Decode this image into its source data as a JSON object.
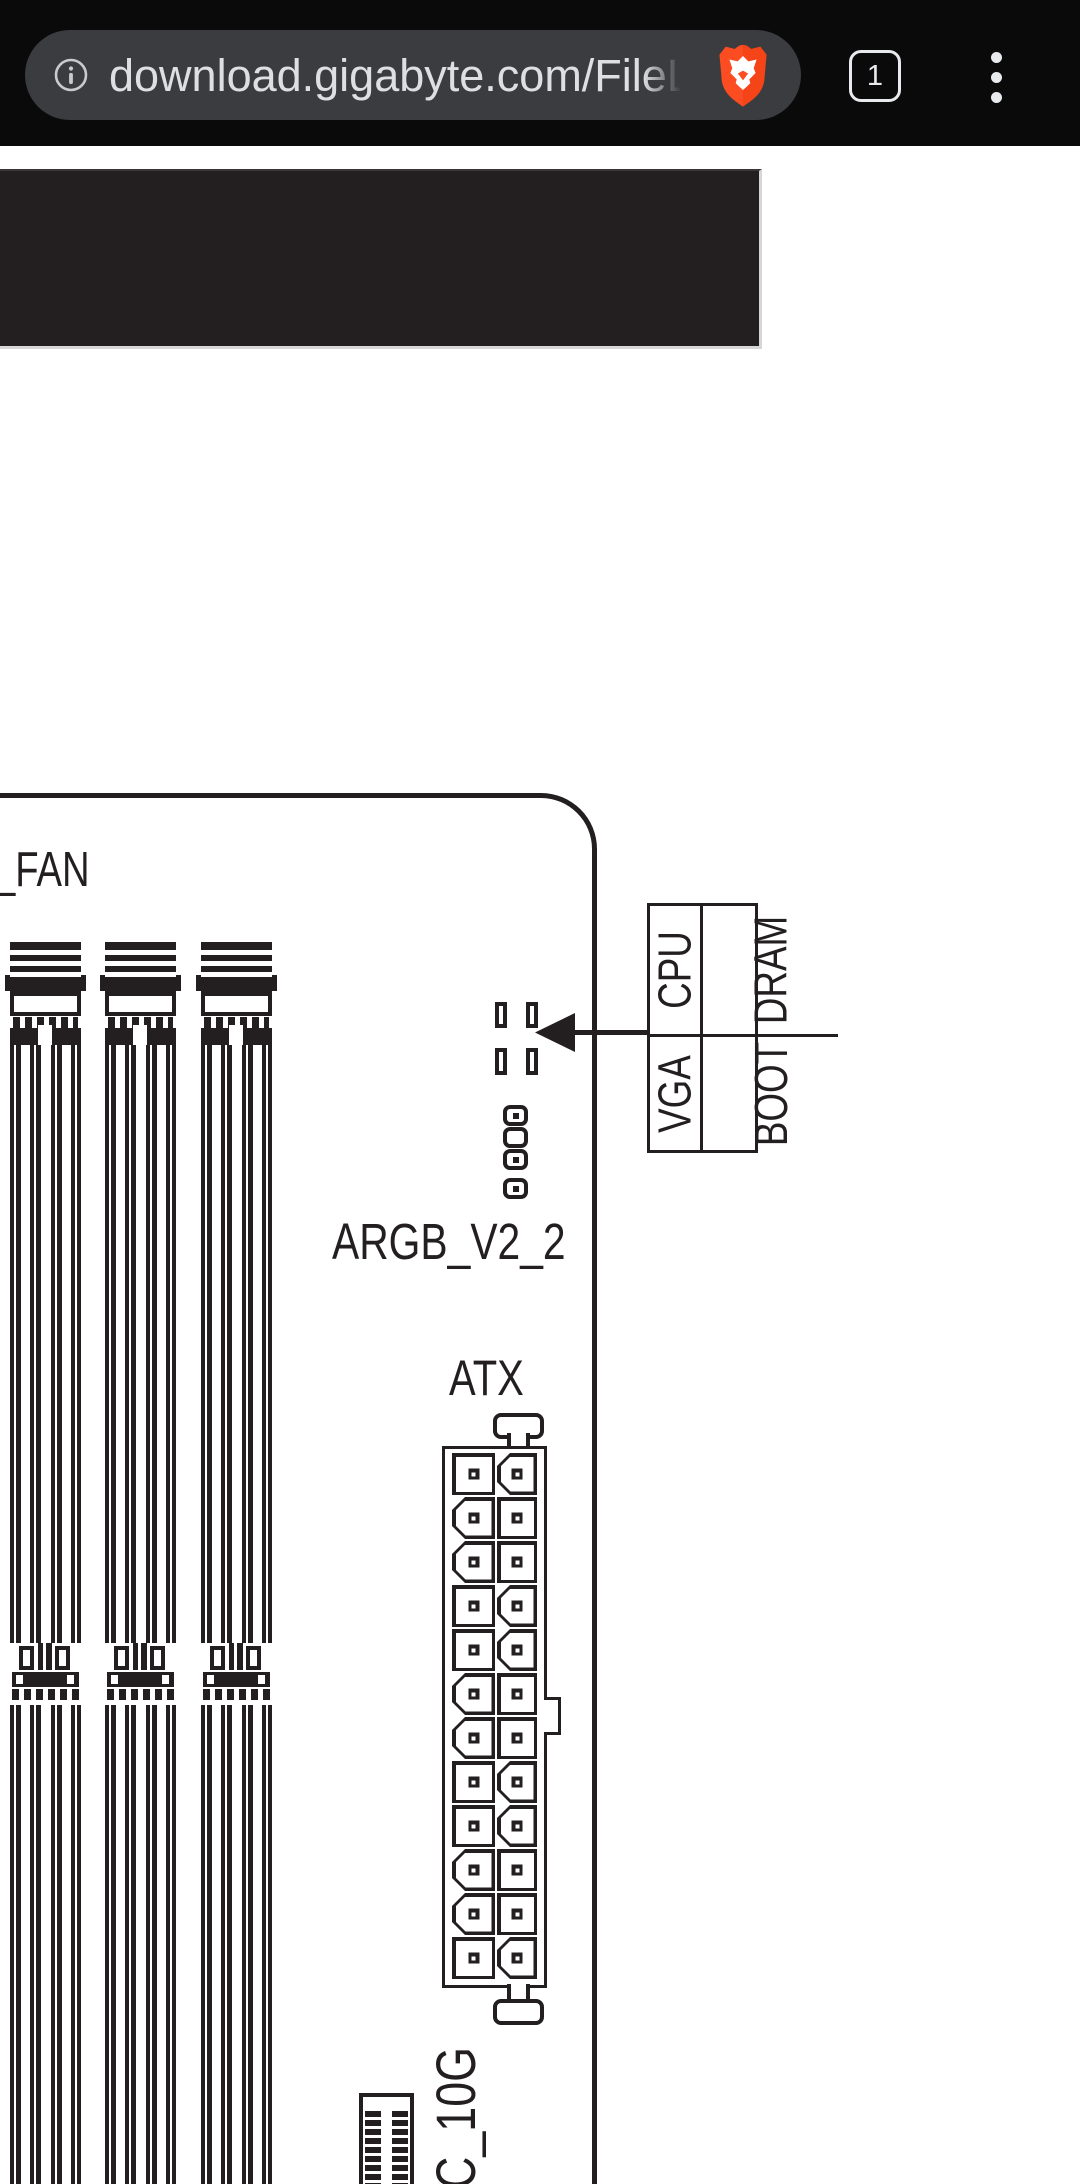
{
  "browser": {
    "toolbar": {
      "url_text": "download.gigabyte.com/FileL",
      "tab_count": "1"
    }
  },
  "diagram": {
    "fan_label": "_FAN",
    "argb_label": "ARGB_V2_2",
    "atx_label": "ATX",
    "usbc_label": "C_10G",
    "debug_led_table": {
      "rows": [
        [
          "CPU",
          "DRAM"
        ],
        [
          "VGA",
          "BOOT"
        ]
      ]
    }
  },
  "colors": {
    "ink": "#231f20",
    "toolbar_bg": "#0a0a0b",
    "url_pill_bg": "#3b3c3f",
    "chrome_text": "#e8eaed",
    "url_text_color": "#dde0e3",
    "brave_orange": "#fb4d21",
    "dark_panel": "#231f20",
    "panel_edge": "#d6d6d6"
  }
}
